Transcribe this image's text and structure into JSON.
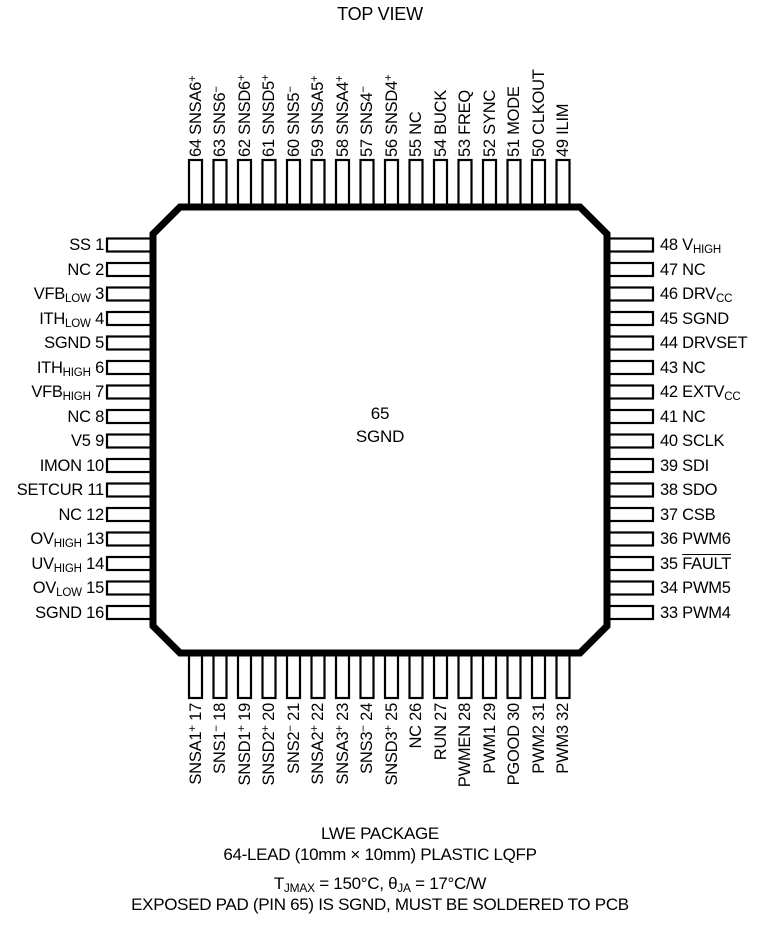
{
  "title": "TOP VIEW",
  "colors": {
    "ink": "#000000",
    "background": "#ffffff"
  },
  "chip": {
    "center_pin": {
      "number": "65",
      "name": "SGND"
    },
    "pins": {
      "top": [
        {
          "num": "64",
          "name": "SNSA6^{+}"
        },
        {
          "num": "63",
          "name": "SNS6^{−}"
        },
        {
          "num": "62",
          "name": "SNSD6^{+}"
        },
        {
          "num": "61",
          "name": "SNSD5^{+}"
        },
        {
          "num": "60",
          "name": "SNS5^{−}"
        },
        {
          "num": "59",
          "name": "SNSA5^{+}"
        },
        {
          "num": "58",
          "name": "SNSA4^{+}"
        },
        {
          "num": "57",
          "name": "SNS4^{−}"
        },
        {
          "num": "56",
          "name": "SNSD4^{+}"
        },
        {
          "num": "55",
          "name": "NC"
        },
        {
          "num": "54",
          "name": "BUCK"
        },
        {
          "num": "53",
          "name": "FREQ"
        },
        {
          "num": "52",
          "name": "SYNC"
        },
        {
          "num": "51",
          "name": "MODE"
        },
        {
          "num": "50",
          "name": "CLKOUT"
        },
        {
          "num": "49",
          "name": "ILIM"
        }
      ],
      "left": [
        {
          "num": "1",
          "name": "SS"
        },
        {
          "num": "2",
          "name": "NC"
        },
        {
          "num": "3",
          "name": "VFB_{LOW}"
        },
        {
          "num": "4",
          "name": "ITH_{LOW}"
        },
        {
          "num": "5",
          "name": "SGND"
        },
        {
          "num": "6",
          "name": "ITH_{HIGH}"
        },
        {
          "num": "7",
          "name": "VFB_{HIGH}"
        },
        {
          "num": "8",
          "name": "NC"
        },
        {
          "num": "9",
          "name": "V5"
        },
        {
          "num": "10",
          "name": "IMON"
        },
        {
          "num": "11",
          "name": "SETCUR"
        },
        {
          "num": "12",
          "name": "NC"
        },
        {
          "num": "13",
          "name": "OV_{HIGH}"
        },
        {
          "num": "14",
          "name": "UV_{HIGH}"
        },
        {
          "num": "15",
          "name": "OV_{LOW}"
        },
        {
          "num": "16",
          "name": "SGND"
        }
      ],
      "right": [
        {
          "num": "48",
          "name": "V_{HIGH}"
        },
        {
          "num": "47",
          "name": "NC"
        },
        {
          "num": "46",
          "name": "DRV_{CC}"
        },
        {
          "num": "45",
          "name": "SGND"
        },
        {
          "num": "44",
          "name": "DRVSET"
        },
        {
          "num": "43",
          "name": "NC"
        },
        {
          "num": "42",
          "name": "EXTV_{CC}"
        },
        {
          "num": "41",
          "name": "NC"
        },
        {
          "num": "40",
          "name": "SCLK"
        },
        {
          "num": "39",
          "name": "SDI"
        },
        {
          "num": "38",
          "name": "SDO"
        },
        {
          "num": "37",
          "name": "CSB"
        },
        {
          "num": "36",
          "name": "PWM6"
        },
        {
          "num": "35",
          "name": "~FAULT~"
        },
        {
          "num": "34",
          "name": "PWM5"
        },
        {
          "num": "33",
          "name": "PWM4"
        }
      ],
      "bottom": [
        {
          "num": "17",
          "name": "SNSA1^{+}"
        },
        {
          "num": "18",
          "name": "SNS1^{−}"
        },
        {
          "num": "19",
          "name": "SNSD1^{+}"
        },
        {
          "num": "20",
          "name": "SNSD2^{+}"
        },
        {
          "num": "21",
          "name": "SNS2^{−}"
        },
        {
          "num": "22",
          "name": "SNSA2^{+}"
        },
        {
          "num": "23",
          "name": "SNSA3^{+}"
        },
        {
          "num": "24",
          "name": "SNS3^{−}"
        },
        {
          "num": "25",
          "name": "SNSD3^{+}"
        },
        {
          "num": "26",
          "name": "NC"
        },
        {
          "num": "27",
          "name": "RUN"
        },
        {
          "num": "28",
          "name": "PWMEN"
        },
        {
          "num": "29",
          "name": "PWM1"
        },
        {
          "num": "30",
          "name": "PGOOD"
        },
        {
          "num": "31",
          "name": "PWM2"
        },
        {
          "num": "32",
          "name": "PWM3"
        }
      ]
    }
  },
  "footer": {
    "package_name": "LWE PACKAGE",
    "package_description": "64-LEAD (10mm × 10mm) PLASTIC LQFP",
    "thermal": "T_{JMAX} = 150°C, θ_{JA} = 17°C/W",
    "note": "EXPOSED PAD (PIN 65) IS SGND, MUST BE SOLDERED TO PCB"
  }
}
